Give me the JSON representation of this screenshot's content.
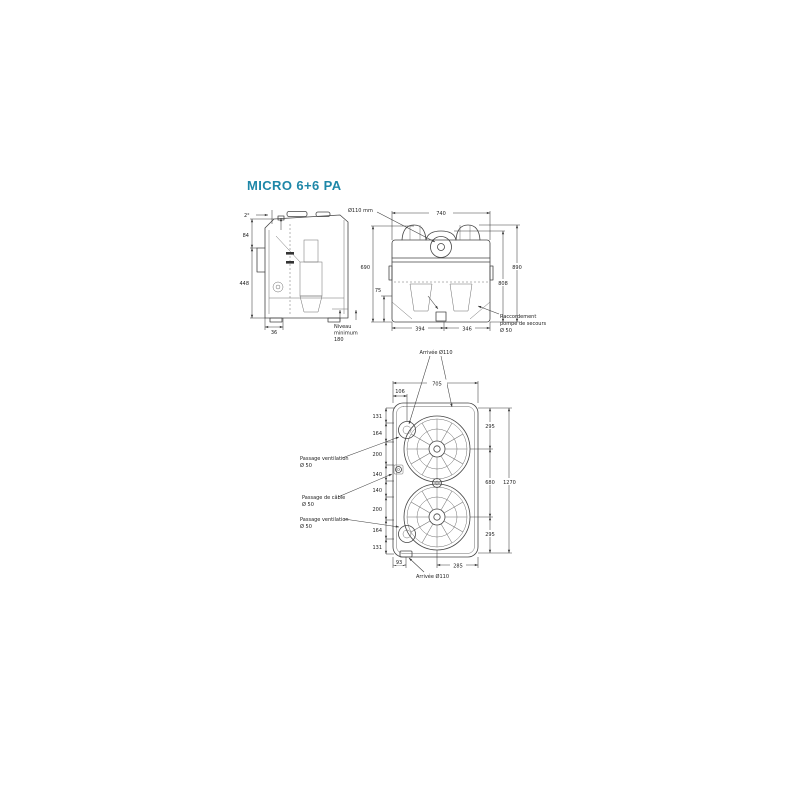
{
  "title": "MICRO 6+6 PA",
  "colors": {
    "accent": "#1e87a8",
    "line": "#454545"
  },
  "side_view": {
    "dim_slope": "2°",
    "dim_height_top": "84",
    "dim_height": "448",
    "dim_bottom": "36",
    "niveau_l1": "Niveau",
    "niveau_l2": "minimum",
    "niveau_l3": "180"
  },
  "front_view": {
    "inlet_label": "Ø110 mm",
    "dim_width": "740",
    "dim_height_left": "690",
    "dim_outlet": "75",
    "dim_height_inner": "808",
    "dim_height_outer": "890",
    "dim_bottom_left": "394",
    "dim_bottom_right": "346",
    "raccordement_l1": "Raccordement",
    "raccordement_l2": "pompe de secours",
    "raccordement_l3": "Ø 50"
  },
  "top_view": {
    "inlet_top_label": "Arrivée Ø110",
    "inlet_bottom_label": "Arrivée Ø110",
    "dim_width": "705",
    "dim_offset": "106",
    "chain": [
      "131",
      "164",
      "200",
      "140",
      "140",
      "200",
      "164",
      "131"
    ],
    "vent_top_l1": "Passage ventilation",
    "vent_top_l2": "Ø 50",
    "cable_l1": "Passage de câble",
    "cable_l2": "Ø 50",
    "vent_bottom_l1": "Passage ventilation",
    "vent_bottom_l2": "Ø 50",
    "dim_right_top": "295",
    "dim_right_mid": "680",
    "dim_right_total": "1270",
    "dim_right_bottom": "295",
    "dim_bottom_left": "93",
    "dim_bottom_right": "285"
  }
}
